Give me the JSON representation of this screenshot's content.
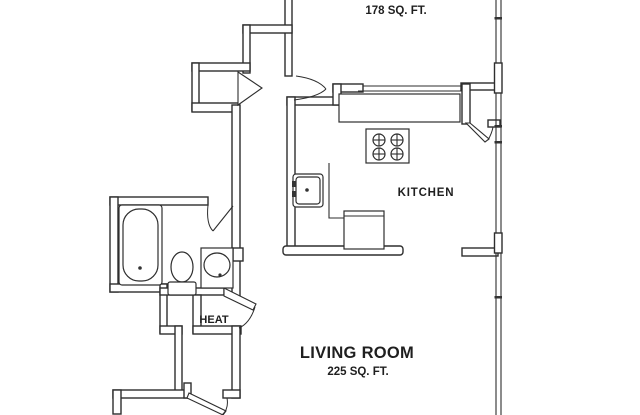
{
  "title": "Apartment floor plan",
  "colors": {
    "wall": "#2e2e2e",
    "background": "#ffffff",
    "text": "#1f1f1f"
  },
  "labels": {
    "bedroom_area": "178 SQ. FT.",
    "kitchen": "KITCHEN",
    "heat": "HEAT",
    "living_room": "LIVING ROOM",
    "living_room_area": "225 SQ. FT."
  },
  "fixtures": [
    "bathtub",
    "toilet",
    "bathroom-sink-vanity",
    "kitchen-sink",
    "stove-4-burner",
    "dishwasher",
    "kitchen-counter",
    "pantry-closet",
    "hall-closet",
    "heat-closet",
    "bottom-closet",
    "exterior-windows"
  ]
}
